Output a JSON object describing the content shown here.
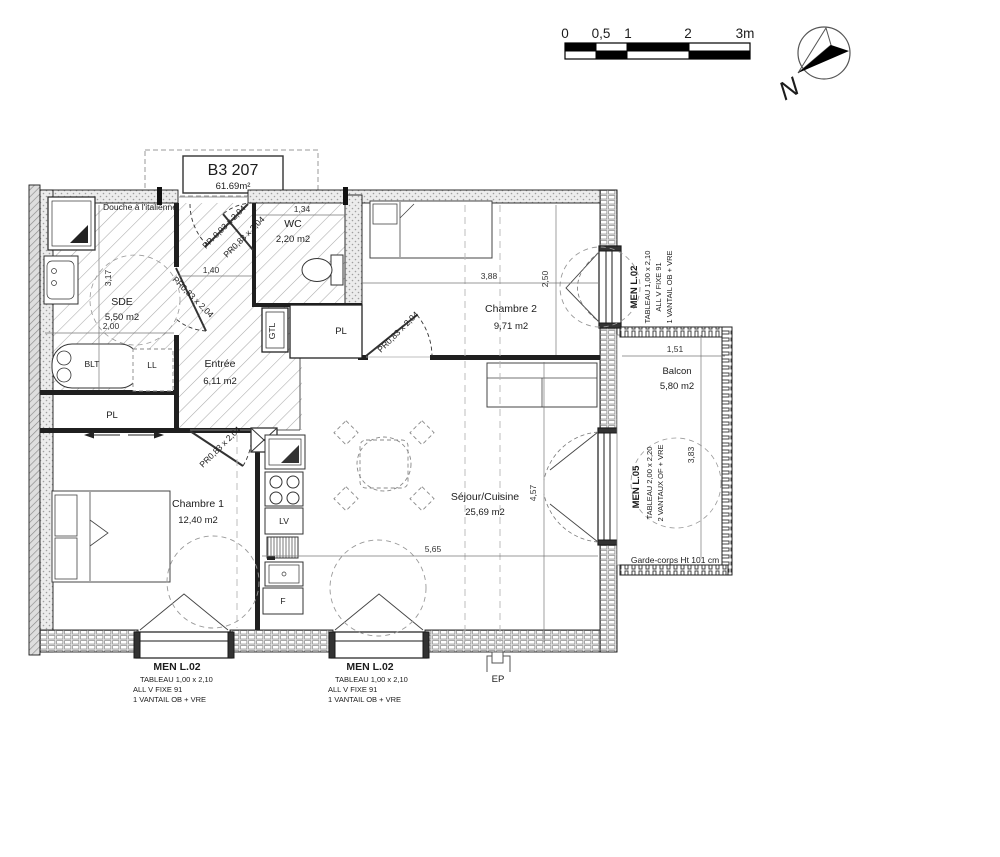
{
  "colors": {
    "ink": "#1c1c1c",
    "hatch": "#adadad",
    "wall_fill": "#ececec"
  },
  "title": {
    "unit": "B3 207",
    "area": "61.69m²"
  },
  "scale_bar": {
    "t0": "0",
    "t05": "0,5",
    "t1": "1",
    "t2": "2",
    "t3": "3m"
  },
  "compass": {
    "north": "N"
  },
  "rooms": {
    "douche": "Douche à l'italienne",
    "sde_name": "SDE",
    "sde_area": "5,50 m2",
    "wc_name": "WC",
    "wc_area": "2,20 m2",
    "entree_name": "Entrée",
    "entree_area": "6,11 m2",
    "ch2_name": "Chambre 2",
    "ch2_area": "9,71 m2",
    "ch1_name": "Chambre 1",
    "ch1_area": "12,40 m2",
    "sejour_name": "Séjour/Cuisine",
    "sejour_area": "25,69 m2",
    "balcon_name": "Balcon",
    "balcon_area": "5,80 m2"
  },
  "equipment": {
    "blt": "BLT",
    "ll": "LL",
    "pl_chambre1": "PL",
    "gtl": "GTL",
    "pl_entree": "PL",
    "lv": "LV",
    "f": "F",
    "ep": "EP"
  },
  "doors": {
    "pp": "PP. 0,93 x 2,04",
    "pr_wc": "PR0,83 x 2,04",
    "pr_sde": "PR0,83 x 2,04",
    "pr_ch2": "PR0,83 x 2,04",
    "pr_ch1": "PR0,83 x 2,04"
  },
  "dims": {
    "d317": "3,17",
    "d200": "2,00",
    "d140": "1,40",
    "d134": "1,34",
    "d388": "3,88",
    "d250": "2,50",
    "d457": "4,57",
    "d565": "5,65",
    "d151": "1,51",
    "d383": "3,83"
  },
  "windows": {
    "right": {
      "name": "MEN L.02",
      "l1": "TABLEAU  1,00 x 2,10",
      "l2": "ALL V FIXE  91",
      "l3": "1 VANTAIL  OB + VRE"
    },
    "l05": {
      "name": "MEN L.05",
      "l1": "TABLEAU  2,00 x 2,20",
      "l2": "2 VANTAUX OF  + VRE"
    },
    "bottom_left": {
      "name": "MEN L.02",
      "l1": "TABLEAU  1,00 x 2,10",
      "l2": "ALL V FIXE  91",
      "l3": "1 VANTAIL  OB + VRE"
    },
    "bottom_right": {
      "name": "MEN L.02",
      "l1": "TABLEAU  1,00 x 2,10",
      "l2": "ALL V FIXE  91",
      "l3": "1 VANTAIL  OB + VRE"
    }
  },
  "annotations": {
    "garde_corps": "Garde-corps Ht 101 cm"
  }
}
